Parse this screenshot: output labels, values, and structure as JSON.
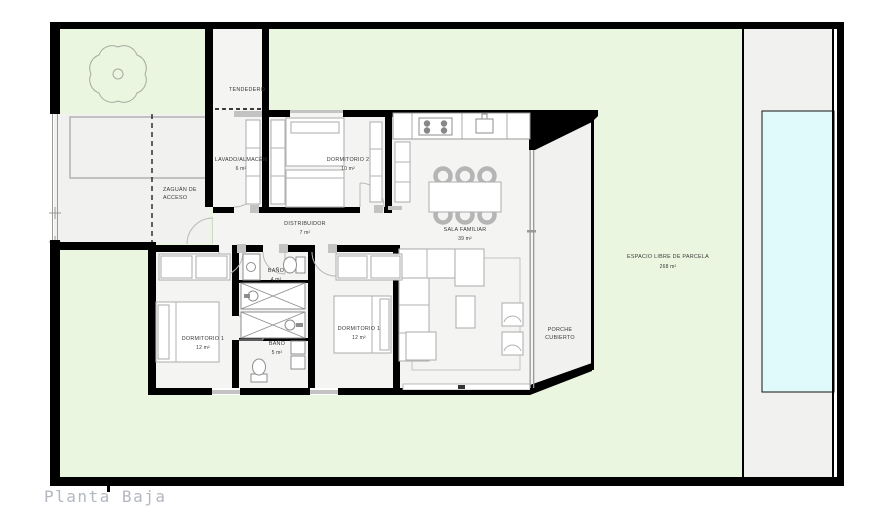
{
  "title": "Planta Baja",
  "colors": {
    "wall": "#000000",
    "garden": "#eaf6df",
    "floor": "#f4f4f3",
    "paving": "#f1f1f0",
    "pool": "#e0fafc",
    "furniture_stroke": "#b2b2b2",
    "label_text": "#3a3a3a",
    "title_text": "#b3b7bf"
  },
  "plan": {
    "labels": {
      "tendedero": {
        "name": "TENDEDERO"
      },
      "zaguan": {
        "line1": "ZAGUÁN DE",
        "line2": "ACCESO"
      },
      "lavado": {
        "name": "LAVADO/ALMACÉN",
        "area": "6 m²"
      },
      "dormitorio2": {
        "name": "DORMITORIO 2",
        "area": "10 m²"
      },
      "distribuidor": {
        "name": "DISTRIBUIDOR",
        "area": "7 m²"
      },
      "sala": {
        "name": "SALA FAMILIAR",
        "area": "39 m²"
      },
      "bano1": {
        "name": "BAÑO",
        "area": "4 m²"
      },
      "bano2": {
        "name": "BAÑO",
        "area": "5 m²"
      },
      "dormitorio1": {
        "name": "DORMITORIO 1",
        "area": "12 m²"
      },
      "dormitorio3": {
        "name": "DORMITORIO 1",
        "area": "12 m²"
      },
      "porche": {
        "line1": "PORCHE",
        "line2": "CUBIERTO"
      },
      "espacio": {
        "name": "ESPACIO LIBRE DE PARCELA",
        "area": "268 m²"
      }
    }
  }
}
